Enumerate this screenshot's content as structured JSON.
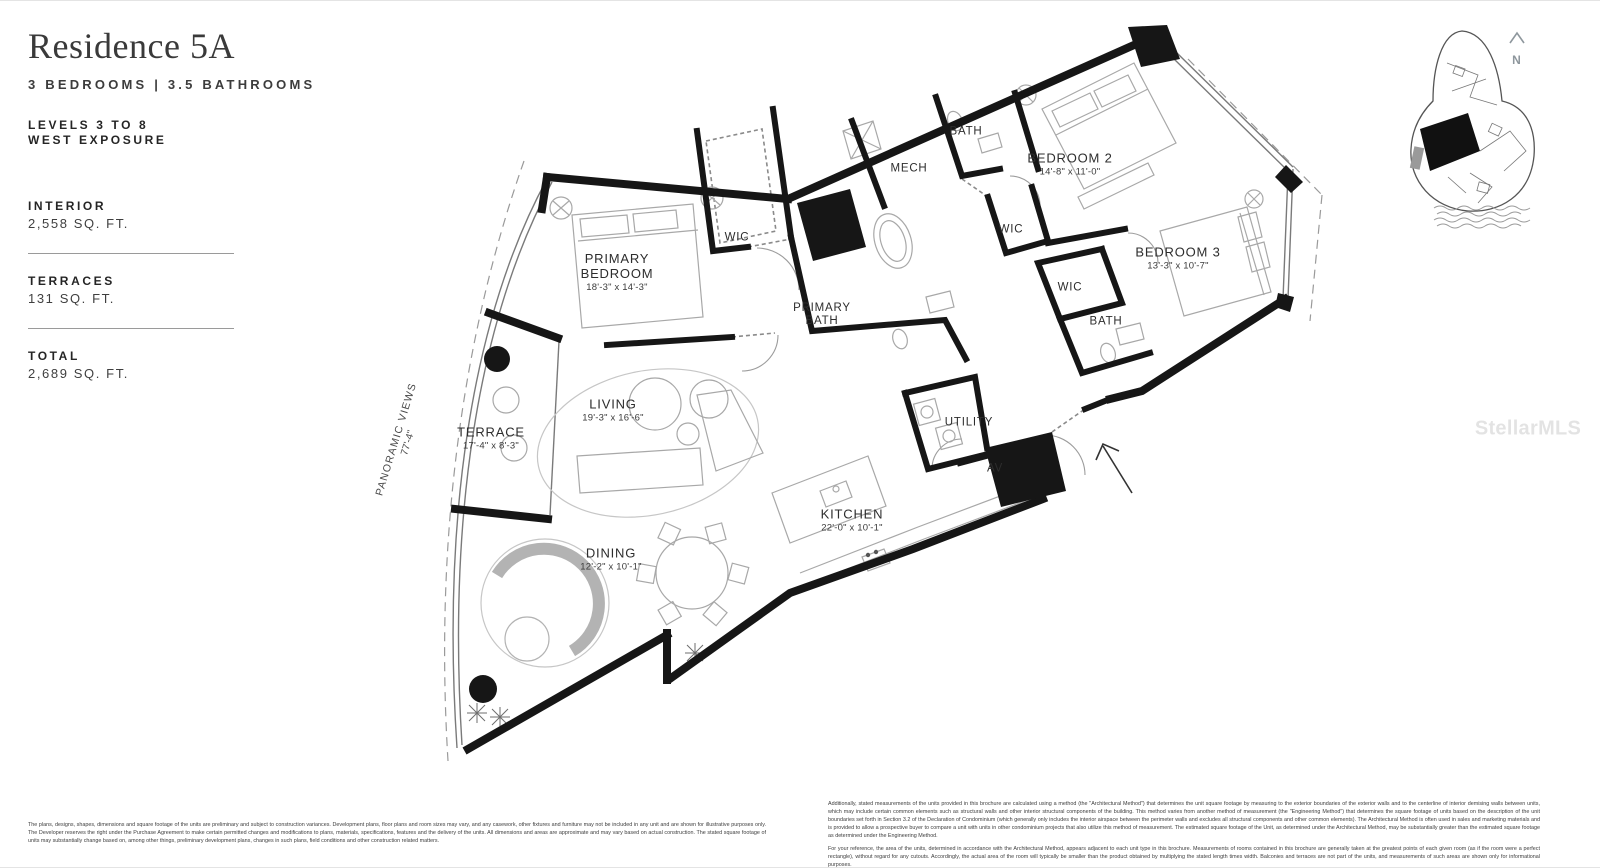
{
  "header": {
    "title": "Residence 5A",
    "subtitle": "3 BEDROOMS | 3.5 BATHROOMS",
    "levels": "LEVELS 3 TO 8",
    "exposure": "WEST EXPOSURE"
  },
  "stats": [
    {
      "label": "INTERIOR",
      "value": "2,558 SQ. FT."
    },
    {
      "label": "TERRACES",
      "value": "131 SQ. FT."
    },
    {
      "label": "TOTAL",
      "value": "2,689 SQ. FT."
    }
  ],
  "rooms": [
    {
      "name": "PRIMARY BEDROOM",
      "dims": "18'-3\" x 14'-3\""
    },
    {
      "name": "WIC",
      "dims": ""
    },
    {
      "name": "PRIMARY BATH",
      "dims": ""
    },
    {
      "name": "MECH",
      "dims": ""
    },
    {
      "name": "BATH",
      "dims": ""
    },
    {
      "name": "BEDROOM 2",
      "dims": "14'-8\" x 11'-0\""
    },
    {
      "name": "WIC",
      "dims": ""
    },
    {
      "name": "BEDROOM 3",
      "dims": "13'-3\" x 10'-7\""
    },
    {
      "name": "WIC",
      "dims": ""
    },
    {
      "name": "BATH",
      "dims": ""
    },
    {
      "name": "UTILITY",
      "dims": ""
    },
    {
      "name": "AV",
      "dims": ""
    },
    {
      "name": "LIVING",
      "dims": "19'-3\" x 16'-6\""
    },
    {
      "name": "TERRACE",
      "dims": "17'-4\" x 8'-3\""
    },
    {
      "name": "KITCHEN",
      "dims": "22'-0\" x 10'-1\""
    },
    {
      "name": "DINING",
      "dims": "12'-2\" x 10'-1\""
    }
  ],
  "annotations": {
    "panoramic_views": "PANORAMIC VIEWS",
    "panoramic_dim": "77'-4\"",
    "compass": "N",
    "watermark": "StellarMLS"
  },
  "disclaimers": {
    "left": "The plans, designs, shapes, dimensions and square footage of the units are preliminary and subject to construction variances. Development plans, floor plans and room sizes may vary, and any casework, other fixtures and furniture may not be included in any unit and are shown for illustrative purposes only. The Developer reserves the right under the Purchase Agreement to make certain permitted changes and modifications to plans, materials, specifications, features and the delivery of the units. All dimensions and areas are approximate and may vary based on actual construction. The stated square footage of units may substantially change based on, among other things, preliminary development plans, changes in such plans, field conditions and other construction related matters.",
    "right_p1": "Additionally, stated measurements of the units provided in this brochure are calculated using a method (the \"Architectural Method\") that determines the unit square footage by measuring to the exterior boundaries of the exterior walls and to the centerline of interior demising walls between units, which may include certain common elements such as structural walls and other interior structural components of the building. This method varies from another method of measurement (the \"Engineering Method\") that determines the square footage of units based on the description of the unit boundaries set forth in Section 3.2 of the Declaration of Condominium (which generally only includes the interior airspace between the perimeter walls and excludes all structural components and other common elements). The Architectural Method is often used in sales and marketing materials and is provided to allow a prospective buyer to compare a unit with units in other condominium projects that also utilize this method of measurement. The estimated square footage of the Unit, as determined under the Architectural Method, may be substantially greater than the estimated square footage as determined under the Engineering Method.",
    "right_p2": "For your reference, the area of the units, determined in accordance with the Architectural Method, appears adjacent to each unit type in this brochure. Measurements of rooms contained in this brochure are generally taken at the greatest points of each given room (as if the room were a perfect rectangle), without regard for any cutouts. Accordingly, the actual area of the room will typically be smaller than the product obtained by multiplying the stated length times width. Balconies and terraces are not part of the units, and measurements of such areas are shown only for informational purposes."
  }
}
